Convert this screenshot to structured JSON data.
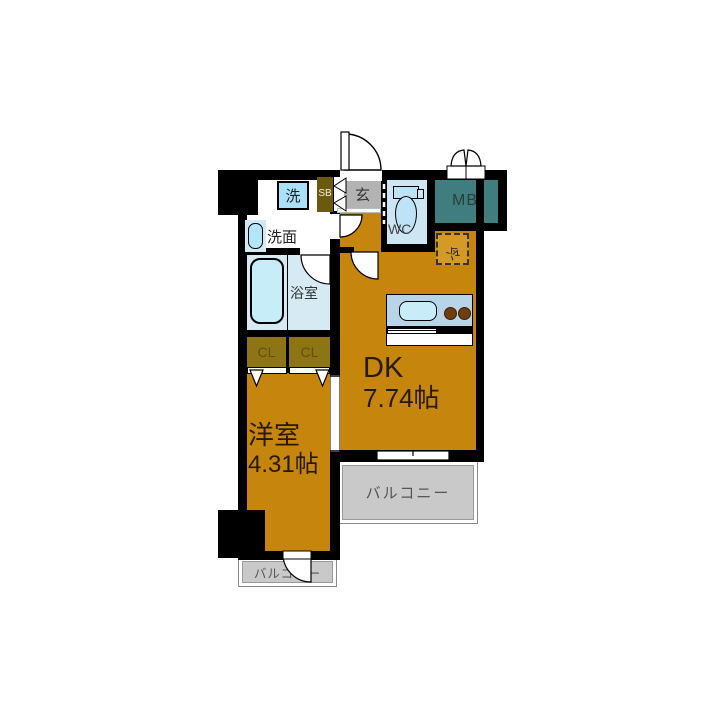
{
  "rooms": {
    "dk": {
      "name": "DK",
      "size": "7.74帖"
    },
    "western": {
      "name": "洋室",
      "size": "4.31帖"
    },
    "bath": {
      "label": "浴室"
    },
    "wash_stand": {
      "label": "洗面"
    },
    "wc": {
      "label": "WC"
    },
    "entrance": {
      "label": "玄"
    },
    "meter_box": {
      "label": "MB"
    },
    "shoe_box": {
      "label": "SB"
    },
    "washer": {
      "label": "洗"
    },
    "fridge": {
      "label": "冷"
    },
    "closet1": {
      "label": "CL"
    },
    "closet2": {
      "label": "CL"
    },
    "balcony_side": {
      "label": "バルコニー"
    },
    "balcony_bottom": {
      "label": "バルコニー"
    }
  },
  "colors": {
    "wall": "#000000",
    "floor_orange": "#c6860d",
    "closet_olive": "#8d7414",
    "shoebox_olive": "#6b590c",
    "entrance_gray": "#b3b3b3",
    "balcony_gray": "#c9c9c9",
    "meter_box_teal": "#3f7d7e",
    "wet_area_blue": "#d5eaf3",
    "fixture_blue": "#c7edf8",
    "kitchen_panel_blue": "#b8d5e8",
    "burner_brown": "#6e3d10"
  }
}
